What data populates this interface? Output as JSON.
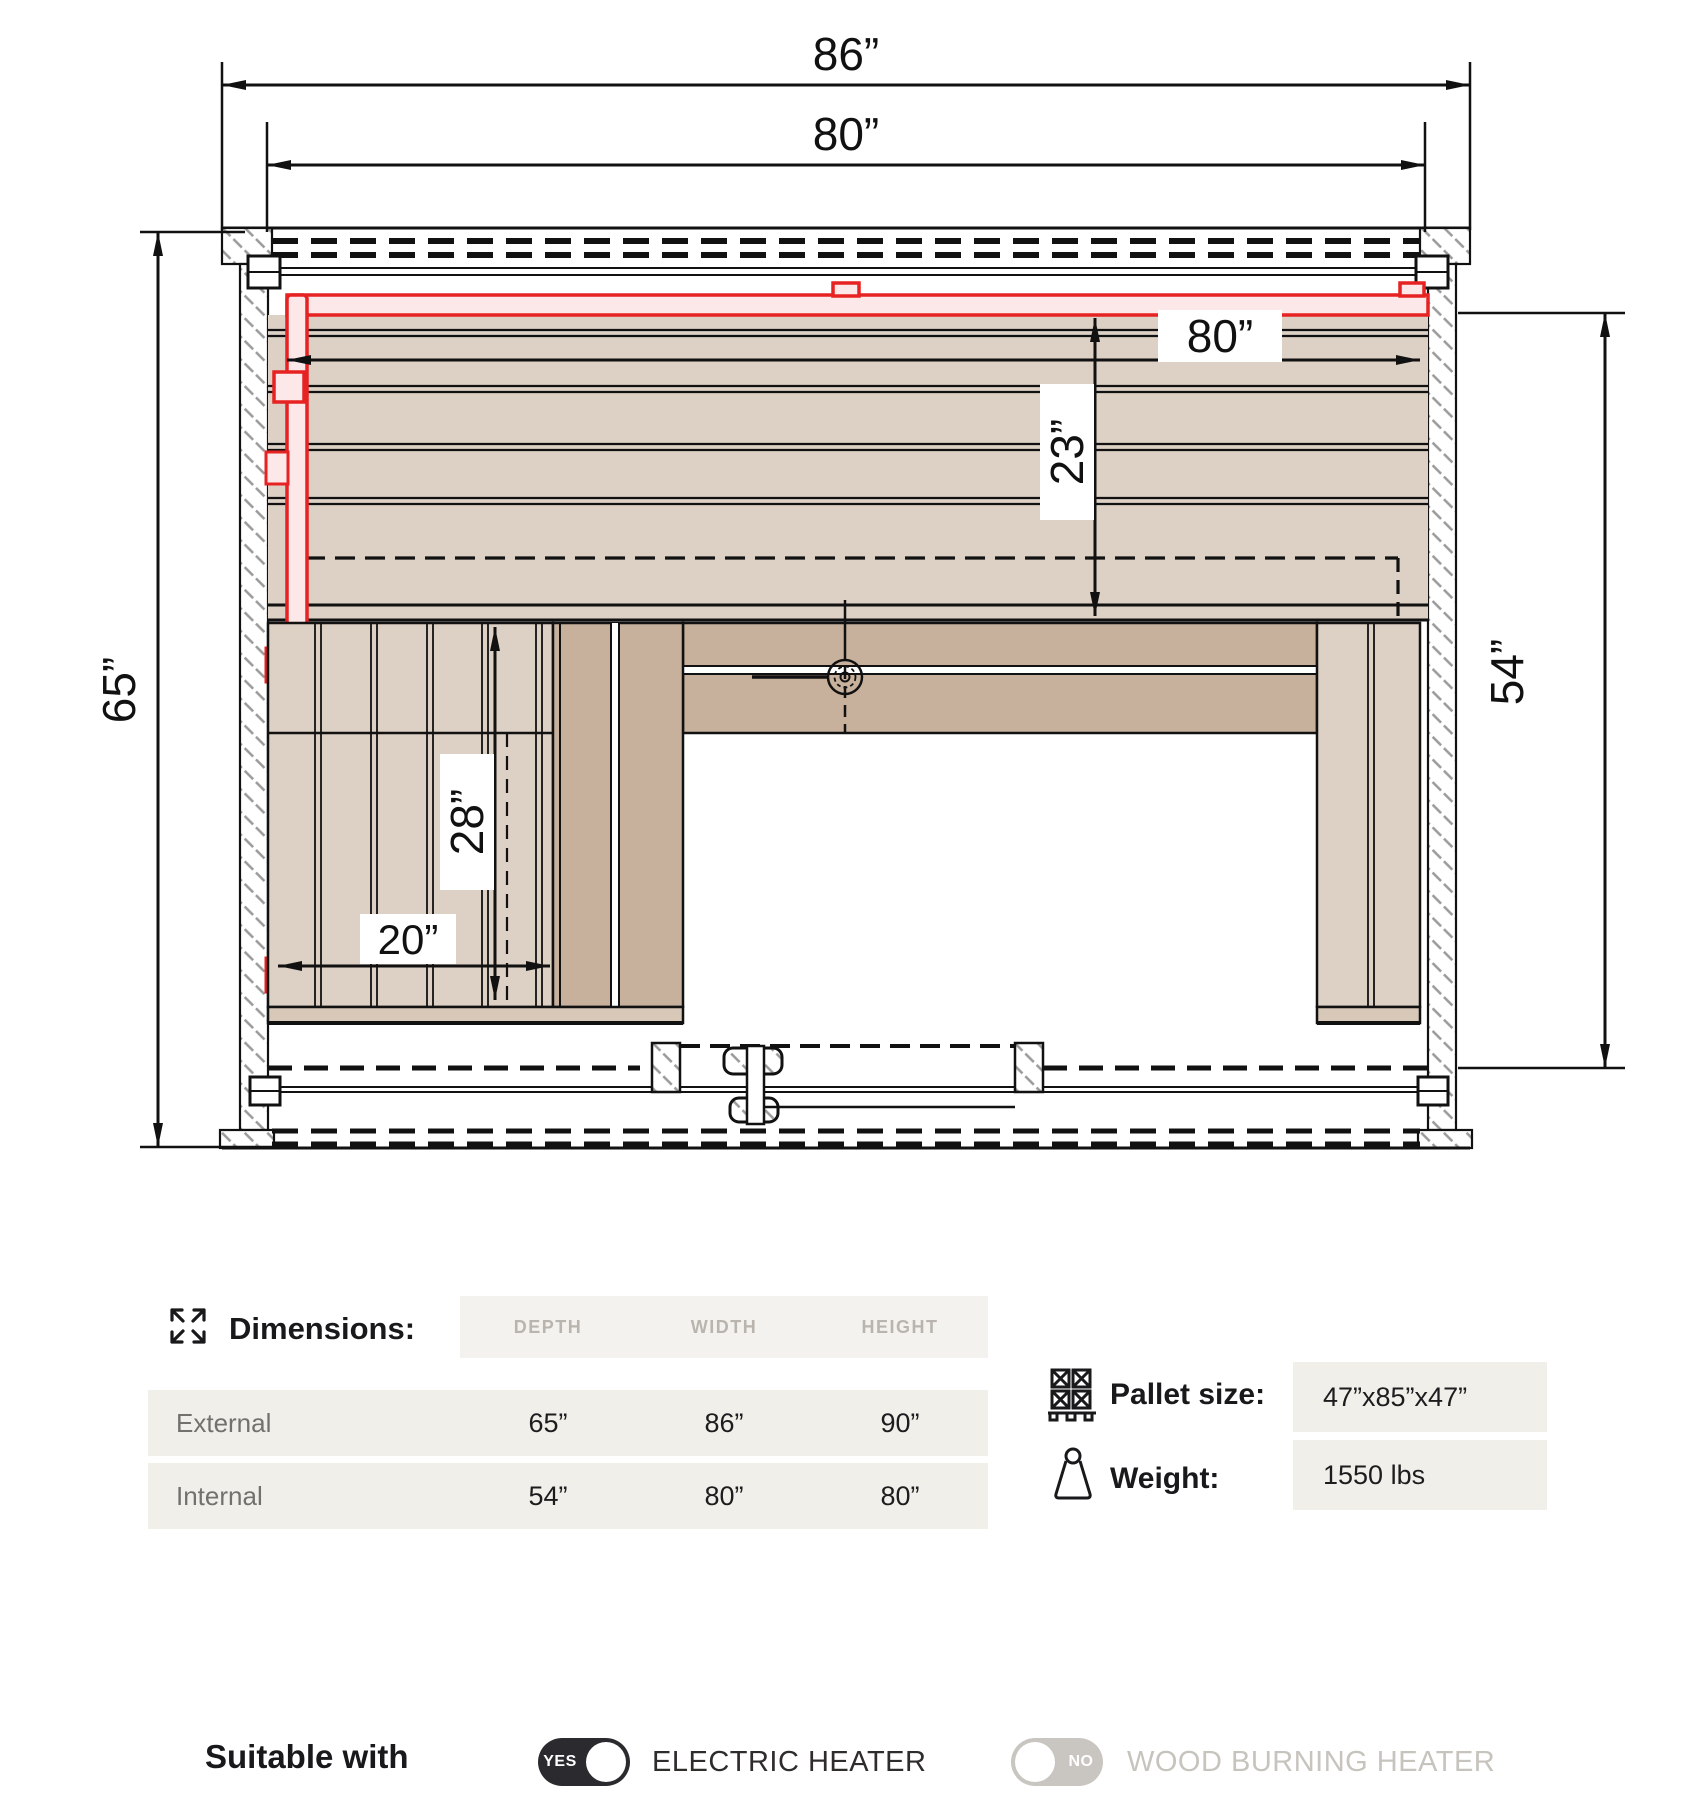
{
  "drawing": {
    "dims": {
      "external_width": "86”",
      "internal_width_top": "80”",
      "external_depth": "65”",
      "internal_width": "80”",
      "back_bench_depth": "23”",
      "internal_depth": "54”",
      "side_bench_length": "28”",
      "side_bench_width": "20”"
    },
    "icons": {
      "vent": "vent-valve-icon"
    },
    "colors": {
      "heater_outline": "#e62222",
      "heater_fill": "#fce8e8",
      "wood_light": "#ddd0c4",
      "wood_dark": "#c8b19c",
      "hatch": "#9a9a9a"
    }
  },
  "specs": {
    "title": "Dimensions:",
    "title_icon": "expand-arrows-icon",
    "columns": [
      "DEPTH",
      "WIDTH",
      "HEIGHT"
    ],
    "rows": [
      {
        "label": "External",
        "values": [
          "65”",
          "86”",
          "90”"
        ]
      },
      {
        "label": "Internal",
        "values": [
          "54”",
          "80”",
          "80”"
        ]
      },
      {
        "label": "_spacer",
        "values": [
          "",
          "",
          ""
        ]
      }
    ],
    "pallet": {
      "icon": "pallet-icon",
      "label": "Pallet size:",
      "value": "47”x85”x47”"
    },
    "weight": {
      "icon": "weight-icon",
      "label": "Weight:",
      "value": "1550 lbs"
    },
    "row_bg": "#f1efe9",
    "muted_text": "#b9b5ae"
  },
  "suitability": {
    "label": "Suitable with",
    "options": [
      {
        "state": "YES",
        "label": "ELECTRIC HEATER",
        "enabled": true
      },
      {
        "state": "NO",
        "label": "WOOD BURNING HEATER",
        "enabled": false
      }
    ],
    "toggle_on_color": "#2b2a2e",
    "toggle_off_color": "#c9c6c1"
  }
}
